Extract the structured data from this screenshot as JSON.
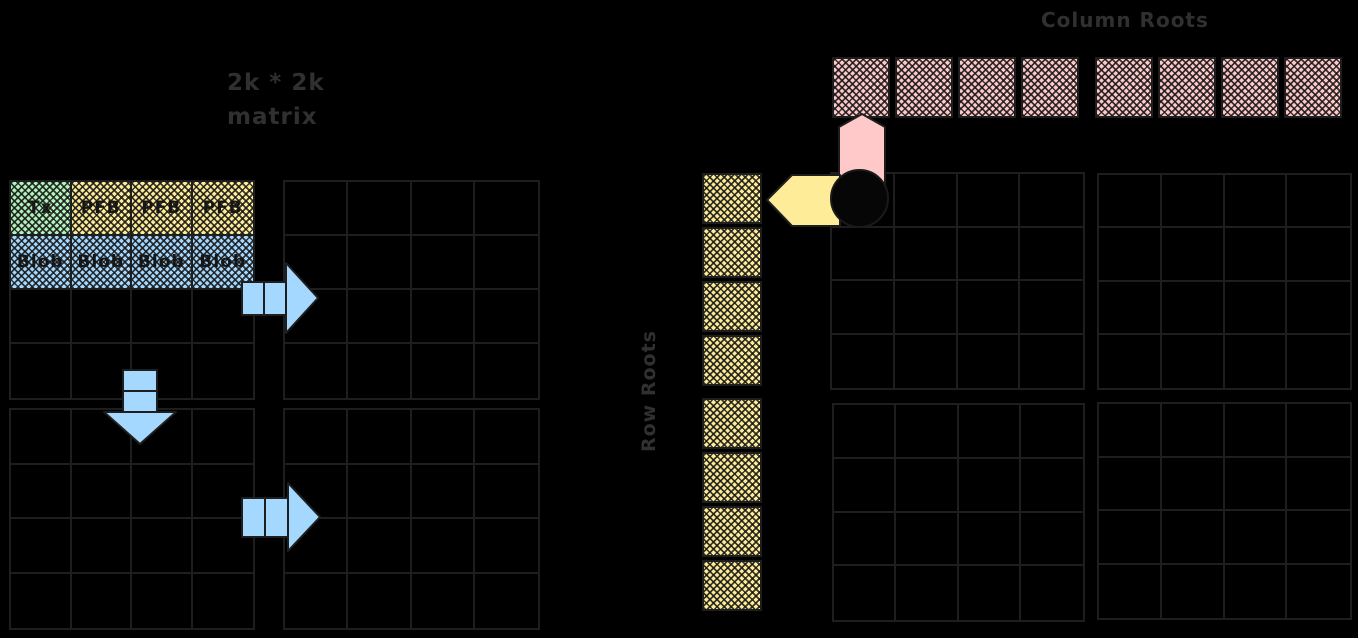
{
  "title": {
    "line1": "2k * 2k",
    "line2": "matrix"
  },
  "labels": {
    "column_roots": "Column Roots",
    "row_roots": "Row Roots"
  },
  "left_matrix": {
    "description_cells": [
      {
        "label": "Tx",
        "color": "green"
      },
      {
        "label": "PFB",
        "color": "yellow"
      },
      {
        "label": "PFB",
        "color": "yellow"
      },
      {
        "label": "PFB",
        "color": "yellow"
      },
      {
        "label": "Blob",
        "color": "blue"
      },
      {
        "label": "Blob",
        "color": "blue"
      },
      {
        "label": "Blob",
        "color": "blue"
      },
      {
        "label": "Blob",
        "color": "blue"
      }
    ],
    "quadrants": 4,
    "cells_per_quadrant": "4x4"
  },
  "right_matrix": {
    "quadrants": 4,
    "cells_per_quadrant": "4x4"
  },
  "column_roots": {
    "count": 8,
    "per_group": 4,
    "groups": 2
  },
  "row_roots": {
    "count": 8,
    "per_group": 4,
    "groups": 2
  },
  "icons": {
    "flow_arrows": [
      "right-arrow",
      "down-arrow",
      "right-arrow"
    ],
    "column_root_pointer": "up-arrow",
    "row_root_pointer": "left-arrow",
    "origin_marker": "filled-circle"
  },
  "colors": {
    "green": "#b2f2bb",
    "yellow": "#ffec99",
    "blue": "#a5d8ff",
    "pink": "#ffc9c9",
    "stroke": "#1e1e1e",
    "background": "#000000"
  }
}
